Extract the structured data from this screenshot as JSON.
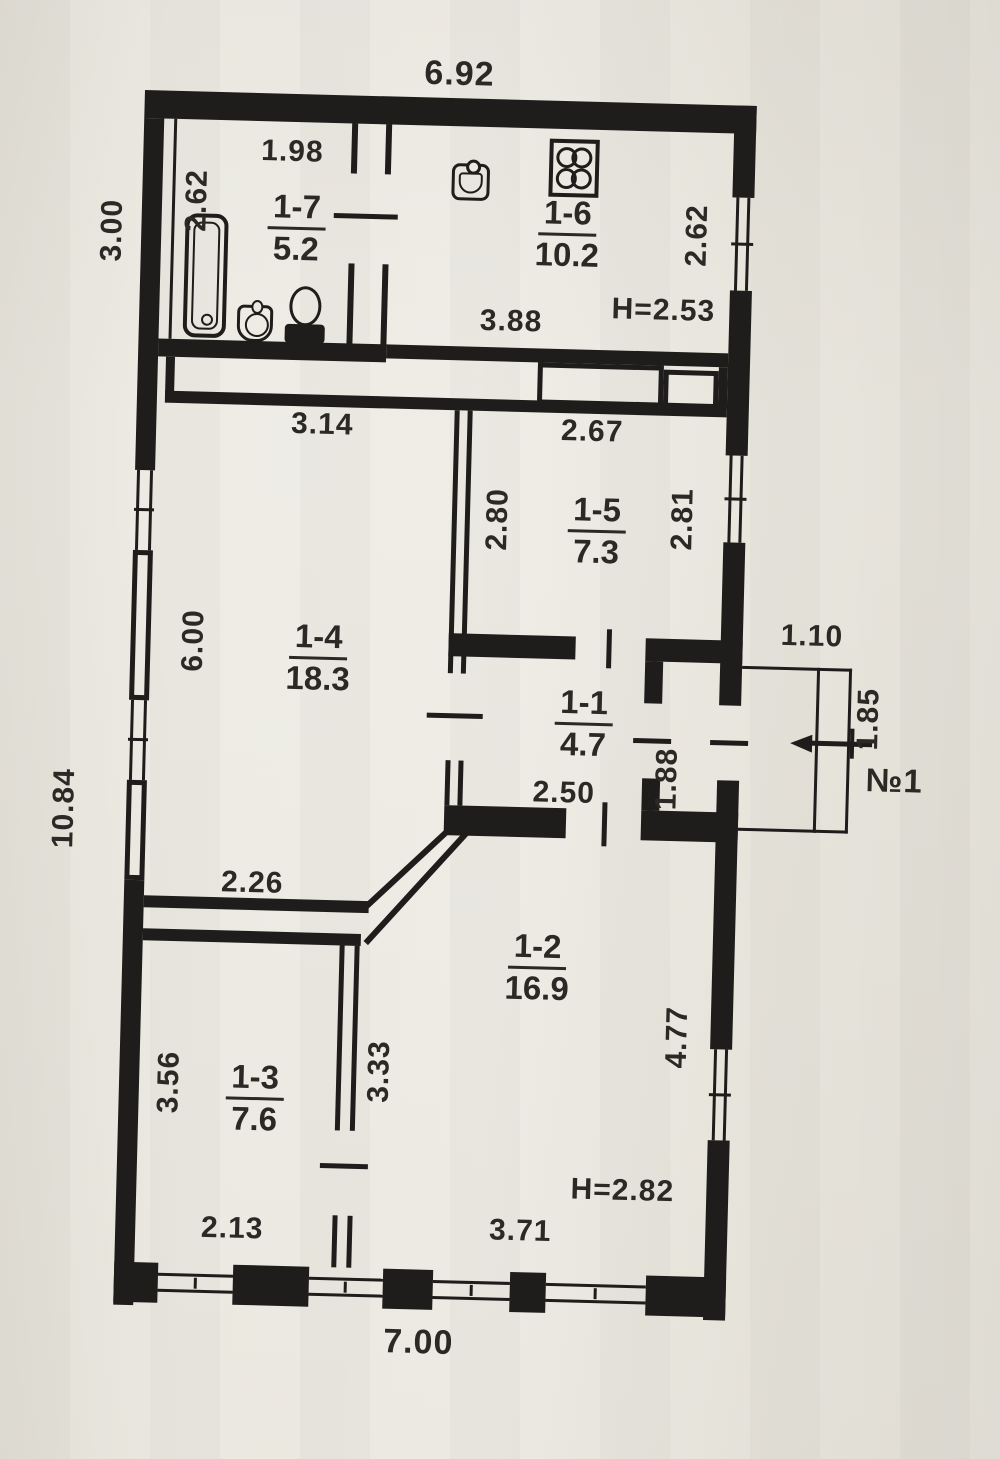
{
  "theme": {
    "paper": "#ebe8df",
    "ink": "#1e1d1b",
    "text": "#2b2925"
  },
  "plan": {
    "rooms": [
      {
        "number": "1-7",
        "area": "5.2"
      },
      {
        "number": "1-6",
        "area": "10.2"
      },
      {
        "number": "1-5",
        "area": "7.3"
      },
      {
        "number": "1-4",
        "area": "18.3"
      },
      {
        "number": "1-1",
        "area": "4.7"
      },
      {
        "number": "1-2",
        "area": "16.9"
      },
      {
        "number": "1-3",
        "area": "7.6"
      }
    ],
    "dimensions": {
      "top_width": "6.92",
      "left_top_height": "3.00",
      "left_total_height": "10.84",
      "bath_width": "1.98",
      "bath_height": "2.62",
      "kitchen_width": "3.88",
      "kitchen_height": "2.62",
      "kitchen_ceiling": "H=2.53",
      "r14_width": "3.14",
      "r14_height": "6.00",
      "r15_width": "2.67",
      "r15_left": "2.80",
      "r15_right": "2.81",
      "r11_width": "2.50",
      "r11_height": "1.88",
      "porch_width": "1.10",
      "porch_depth": "1.85",
      "porch_label": "№1",
      "r13_top": "2.26",
      "r13_left": "3.56",
      "r13_right": "3.33",
      "r13_bottom": "2.13",
      "r12_right": "4.77",
      "r12_bottom": "3.71",
      "r12_ceiling": "H=2.82",
      "bottom_width": "7.00"
    }
  }
}
